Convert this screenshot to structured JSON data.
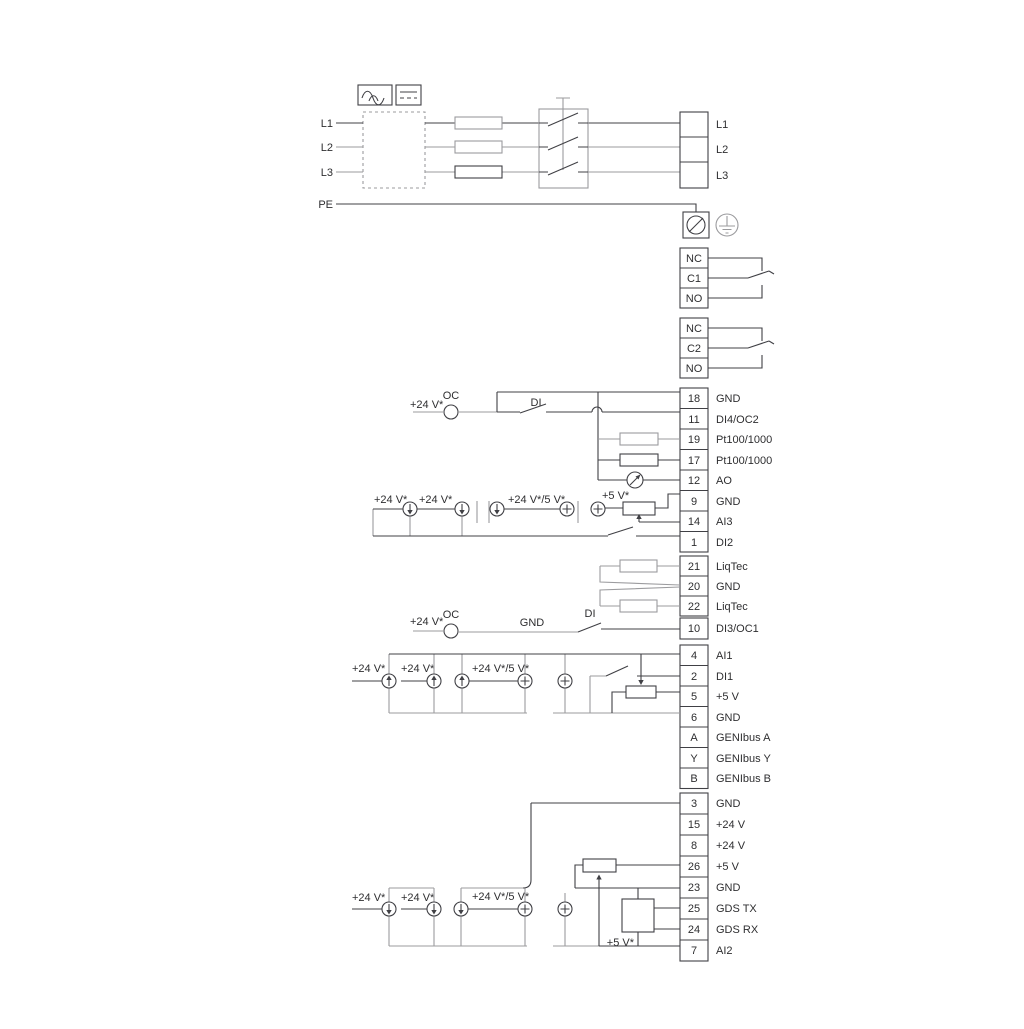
{
  "colors": {
    "ink": "#404045",
    "gray": "#9b9b9e",
    "bg": "#ffffff"
  },
  "pw": {
    "l1": "L1",
    "l2": "L2",
    "l3": "L3",
    "pe": "PE"
  },
  "po": [
    "L1",
    "L2",
    "L3"
  ],
  "r1": [
    "NC",
    "C1",
    "NO"
  ],
  "r2": [
    "NC",
    "C2",
    "NO"
  ],
  "sa": [
    {
      "n": "18",
      "l": "GND"
    },
    {
      "n": "11",
      "l": "DI4/OC2"
    },
    {
      "n": "19",
      "l": "Pt100/1000"
    },
    {
      "n": "17",
      "l": "Pt100/1000"
    },
    {
      "n": "12",
      "l": "AO"
    },
    {
      "n": "9",
      "l": "GND"
    },
    {
      "n": "14",
      "l": "AI3"
    },
    {
      "n": "1",
      "l": "DI2"
    }
  ],
  "sb": [
    {
      "n": "21",
      "l": "LiqTec"
    },
    {
      "n": "20",
      "l": "GND"
    },
    {
      "n": "22",
      "l": "LiqTec"
    }
  ],
  "t10": {
    "n": "10",
    "l": "DI3/OC1"
  },
  "sc": [
    {
      "n": "4",
      "l": "AI1"
    },
    {
      "n": "2",
      "l": "DI1"
    },
    {
      "n": "5",
      "l": "+5 V"
    },
    {
      "n": "6",
      "l": "GND"
    },
    {
      "n": "A",
      "l": "GENIbus A"
    },
    {
      "n": "Y",
      "l": "GENIbus Y"
    },
    {
      "n": "B",
      "l": "GENIbus B"
    }
  ],
  "sd": [
    {
      "n": "3",
      "l": "GND"
    },
    {
      "n": "15",
      "l": "+24 V"
    },
    {
      "n": "8",
      "l": "+24 V"
    },
    {
      "n": "26",
      "l": "+5 V"
    },
    {
      "n": "23",
      "l": "GND"
    },
    {
      "n": "25",
      "l": "GDS TX"
    },
    {
      "n": "24",
      "l": "GDS RX"
    },
    {
      "n": "7",
      "l": "AI2"
    }
  ],
  "lb": {
    "p24": "+24 V*",
    "p245": "+24 V*/5 V*",
    "p5": "+5 V*",
    "oc": "OC",
    "di": "DI",
    "gnd": "GND"
  }
}
